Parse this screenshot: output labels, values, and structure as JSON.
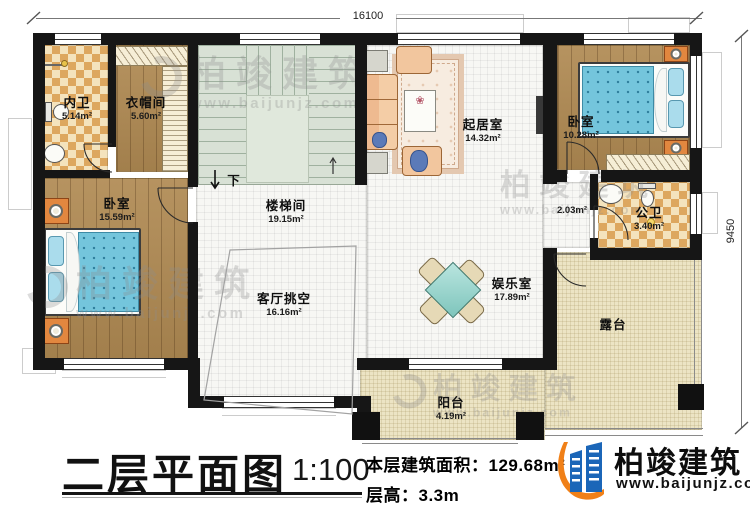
{
  "plan_title": {
    "text": "二层平面图",
    "scale": "1:100"
  },
  "info": {
    "floor_area": "本层建筑面积：129.68m²",
    "floor_height": "层高：3.3m"
  },
  "brand": {
    "name": "柏竣建筑",
    "url": "www.baijunjz.com"
  },
  "watermark": {
    "text": "柏竣建筑",
    "url": "www.baijunjz.com"
  },
  "dimensions": {
    "top": "16100",
    "right": "9450"
  },
  "rooms": {
    "neiwei": {
      "name": "内卫",
      "area": "5.14m²"
    },
    "yimaojian": {
      "name": "衣帽间",
      "area": "5.60m²"
    },
    "woshi_left": {
      "name": "卧室",
      "area": "15.59m²"
    },
    "loutijian": {
      "name": "楼梯间",
      "area": "19.15m²"
    },
    "keting_tiaokong": {
      "name": "客厅挑空",
      "area": "16.16m²"
    },
    "qijushi": {
      "name": "起居室",
      "area": "14.32m²"
    },
    "woshi_right": {
      "name": "卧室",
      "area": "10.28m²"
    },
    "gongwei": {
      "name": "公卫",
      "area": "3.40m²"
    },
    "yuleshi": {
      "name": "娱乐室",
      "area": "17.89m²"
    },
    "lutai": {
      "name": "露台",
      "area": ""
    },
    "yangtai": {
      "name": "阳台",
      "area": "4.19m²"
    }
  },
  "annotations": {
    "corridor_area": "2.03m²",
    "stair_direction": "下"
  },
  "colors": {
    "wall": "#161616",
    "wood_floor": "#b08a52",
    "tile_accent": "#dda75f",
    "stair": "#d8e1d5",
    "bed": "#74c5dc",
    "logo_blue": "#1b66b8",
    "logo_orange": "#f08018"
  }
}
